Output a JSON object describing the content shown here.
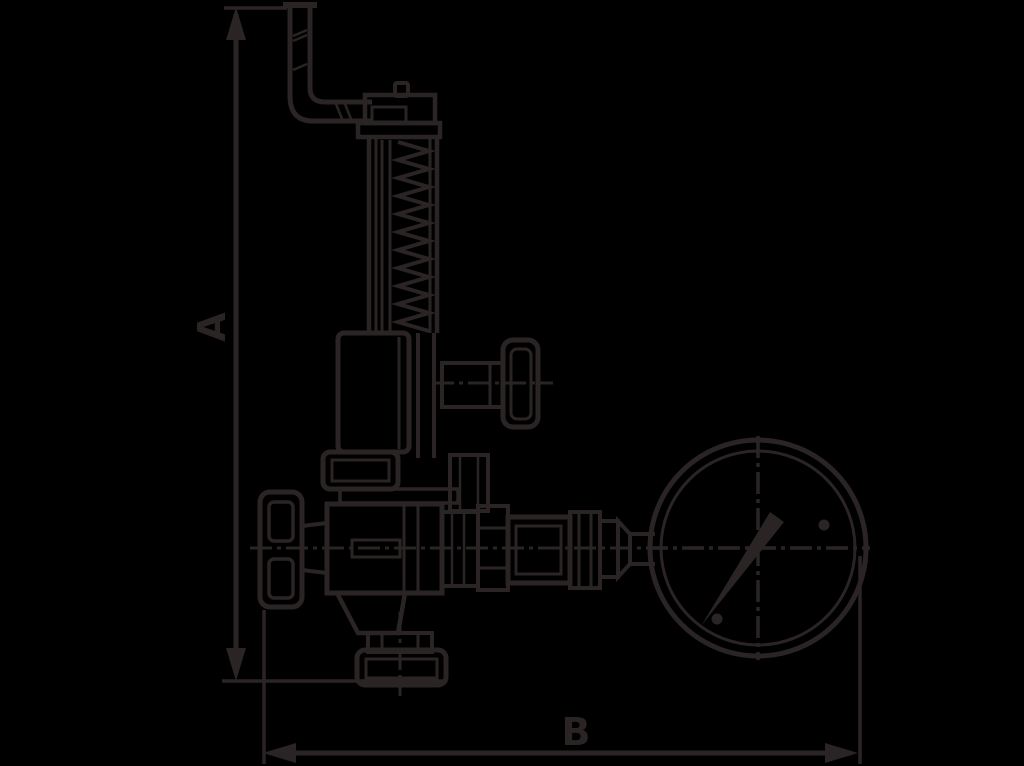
{
  "labels": {
    "dim_a": "A",
    "dim_b": "B"
  },
  "colors": {
    "background": "#000000",
    "ink": "#2a2425"
  }
}
